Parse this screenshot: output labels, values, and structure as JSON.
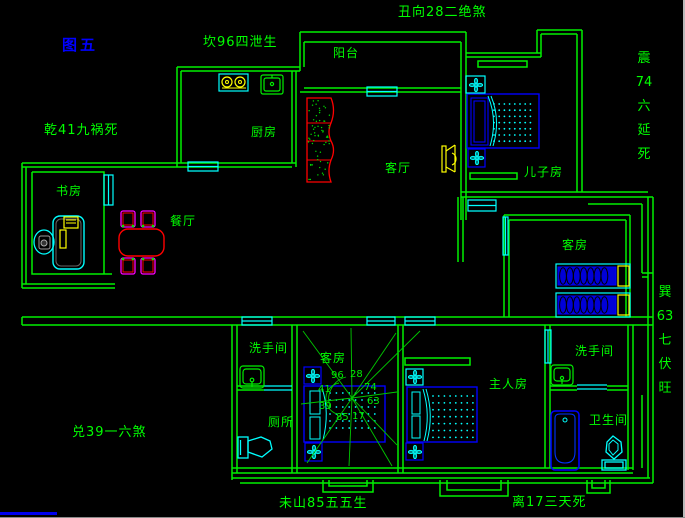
{
  "figure_label": {
    "text": "图五",
    "color": "#0000ff"
  },
  "perimeter_annotations": {
    "north": "坎96四泄生",
    "northeast": "丑向28二绝煞",
    "northwest": "乾41九祸死",
    "east_upper": {
      "text": "震74六延死",
      "segments": [
        "震",
        "74",
        "六",
        "延",
        "死"
      ]
    },
    "east_lower": {
      "text": "巽63七伏旺",
      "segments": [
        "巽",
        "63",
        "七",
        "伏",
        "旺"
      ]
    },
    "west": "兑39一六煞",
    "south_left": "未山85五五生",
    "south_right": "离17三天死"
  },
  "room_labels": {
    "balcony": "阳台",
    "kitchen": "厨房",
    "living_room": "客厅",
    "son_room": "儿子房",
    "study": "书房",
    "dining": "餐厅",
    "guest_room_east": "客房",
    "guest_room_center": "客房",
    "washroom_west": "洗手间",
    "washroom_east": "洗手间",
    "master_room": "主人房",
    "toilet": "厕所",
    "bathroom": "卫生间"
  },
  "compass_numbers": [
    "96",
    "28",
    "41",
    "74",
    "39",
    "63",
    "85",
    "17"
  ],
  "colors": {
    "background": "#000000",
    "wall_green": "#00ef00",
    "text_green": "#00ff00",
    "window_cyan": "#00ffff",
    "furniture_blue": "#0000ff",
    "accent_yellow": "#ffff00",
    "accent_red": "#ff0000",
    "accent_magenta": "#ff00ff",
    "figure_blue": "#0000ff"
  }
}
